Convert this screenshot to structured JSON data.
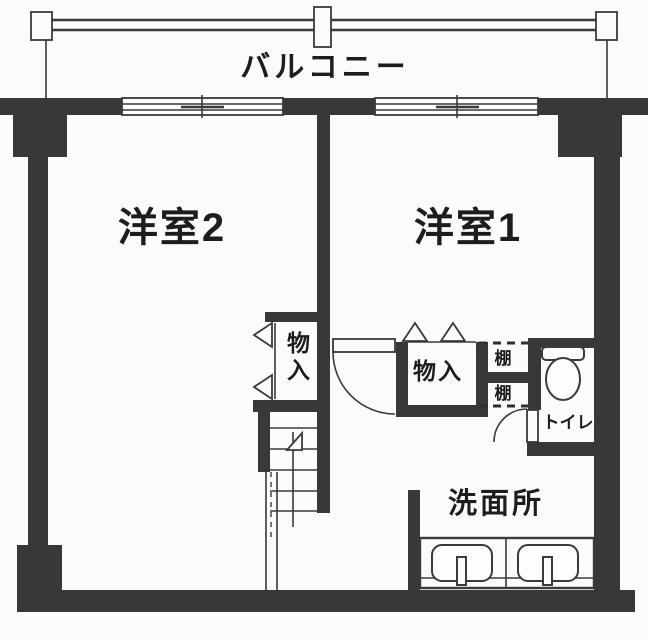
{
  "floorplan": {
    "balcony_label": "バルコニー",
    "room2_label": "洋室2",
    "room1_label": "洋室1",
    "storage_left_label": "物入",
    "storage_mid_label": "物入",
    "shelf_top_label": "棚",
    "shelf_bottom_label": "棚",
    "toilet_label": "トイレ",
    "washroom_label": "洗面所",
    "colors": {
      "wall": "#383838",
      "line": "#3a3a3a",
      "background": "#fbfbfa"
    }
  }
}
